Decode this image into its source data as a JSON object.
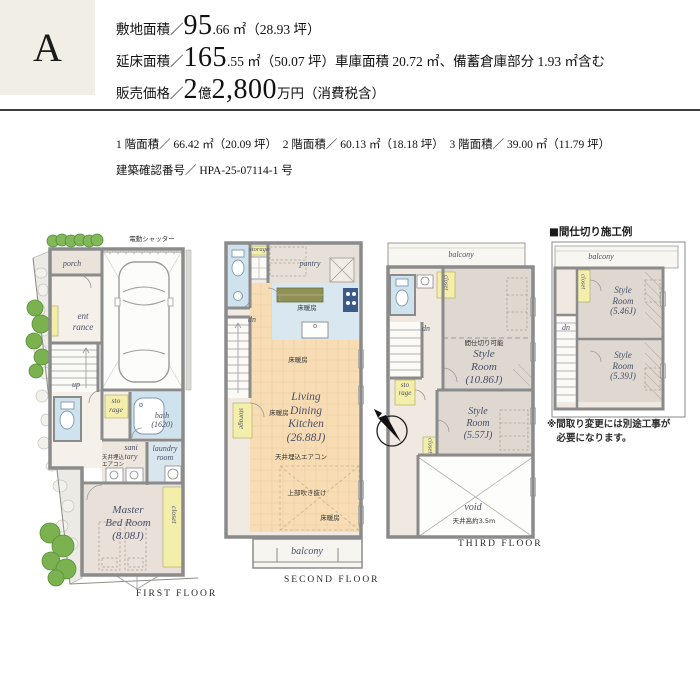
{
  "header": {
    "plan_label": "A",
    "site": {
      "label": "敷地面積／",
      "big": "95",
      "rest": ".66 ㎡（28.93 坪）"
    },
    "floor": {
      "label": "延床面積／",
      "big": "165",
      "rest": ".55 ㎡（50.07 坪）車庫面積 20.72 ㎡、備蓄倉庫部分 1.93 ㎡含む"
    },
    "price": {
      "label": "販売価格／",
      "big1": "2",
      "unit": "億",
      "big2": "2,800",
      "rest": "万円（消費税含）"
    }
  },
  "details": {
    "areas": "1 階面積／ 66.42 ㎡（20.09 坪）　2 階面積／ 60.13 ㎡（18.18 坪）　3 階面積／ 39.00 ㎡（11.79 坪）",
    "confirmation": "建築確認番号／ HPA-25-07114-1 号"
  },
  "plans": {
    "first": {
      "title": "FIRST FLOOR",
      "shutter": "電動シャッター",
      "porch": "porch",
      "entrance": "ent\nrance",
      "up": "up",
      "storage": "sto\nrage",
      "bath": "bath\n(1620)",
      "aircon": "天井埋込\nエアコン",
      "sanitary": "sani\ntary",
      "laundry": "laundry\nroom",
      "master": "Master\nBed Room\n(8.08J)",
      "closet": "closet"
    },
    "second": {
      "title": "SECOND FLOOR",
      "storage_top": "storage",
      "pantry": "pantry",
      "dn": "dn",
      "floor_heating": "床暖房",
      "ldk": "Living\nDining\nKitchen\n(26.88J)",
      "aircon": "天井埋込エアコン",
      "open_above": "上部吹き抜け",
      "storage_left": "storage",
      "balcony": "balcony"
    },
    "third": {
      "title": "THIRD FLOOR",
      "balcony": "balcony",
      "closet_upper": "closet",
      "dn": "dn",
      "partitionable": "間仕切り可能",
      "style_large": "Style\nRoom\n(10.86J)",
      "storage": "sto\nrage",
      "style_small": "Style\nRoom\n(5.57J)",
      "closet_lower": "closet",
      "void": "void",
      "ceiling_height": "天井高約3.5m"
    },
    "partition": {
      "title": "■間仕切り施工例",
      "balcony": "balcony",
      "closet": "closet",
      "style_a": "Style\nRoom\n(5.46J)",
      "dn": "dn",
      "style_b": "Style\nRoom\n(5.39J)",
      "note": "※間取り変更には別途工事が\n　必要になります。"
    }
  }
}
